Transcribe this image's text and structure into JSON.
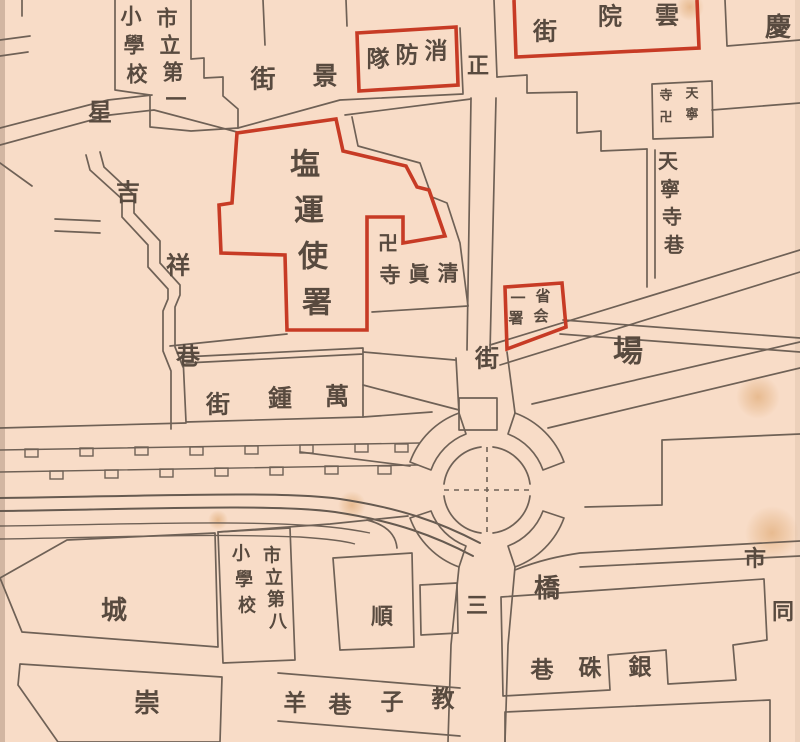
{
  "map": {
    "type": "historical-city-map",
    "colors": {
      "paper": "#f8dcc7",
      "line": "#6f6156",
      "red": "#c73b25",
      "ink": "#584a3f"
    },
    "landmarks_in_red": [
      "消防隊",
      "雲院街",
      "塩運使署",
      "省会一署"
    ],
    "labels": [
      {
        "name": "school-1-col-right",
        "text": "市立第一",
        "x": 167,
        "y": 18,
        "dx": 3,
        "dy": 27,
        "size": 21
      },
      {
        "name": "school-1-col-left",
        "text": "小學校",
        "x": 131,
        "y": 16,
        "dx": 3,
        "dy": 29,
        "size": 21
      },
      {
        "name": "star",
        "text": "星",
        "x": 100,
        "y": 112,
        "size": 24
      },
      {
        "name": "jing-street",
        "chars": [
          {
            "c": "景",
            "x": 325,
            "y": 76
          },
          {
            "c": "街",
            "x": 263,
            "y": 79
          }
        ],
        "size": 25
      },
      {
        "name": "fire-brigade-box-label",
        "text": "消防隊",
        "x": 436,
        "y": 51,
        "dx": -29,
        "dy": 4,
        "size": 23
      },
      {
        "name": "zheng",
        "text": "正",
        "x": 478,
        "y": 66,
        "size": 22
      },
      {
        "name": "yunyuan-street-box-label",
        "chars": [
          {
            "c": "雲",
            "x": 667,
            "y": 15
          },
          {
            "c": "院",
            "x": 610,
            "y": 16
          },
          {
            "c": "街",
            "x": 545,
            "y": 31
          }
        ],
        "size": 24
      },
      {
        "name": "qing-char",
        "text": "慶",
        "x": 778,
        "y": 28,
        "size": 26
      },
      {
        "name": "tianning-temple-box-col-right",
        "text": "天寧",
        "x": 692,
        "y": 94,
        "dx": 0,
        "dy": 21,
        "size": 13
      },
      {
        "name": "tianning-temple-box-col-left",
        "text": "寺卍",
        "x": 666,
        "y": 96,
        "dx": 0,
        "dy": 22,
        "size": 13
      },
      {
        "name": "tianning-temple-lane",
        "text": "天寧寺巷",
        "x": 668,
        "y": 161,
        "dx": 2,
        "dy": 28,
        "size": 20
      },
      {
        "name": "salt-transport-office",
        "text": "塩運使署",
        "x": 305,
        "y": 165,
        "dx": 4,
        "dy": 46,
        "size": 30
      },
      {
        "name": "mosque-swastika",
        "text": "卍",
        "x": 388,
        "y": 243,
        "size": 20
      },
      {
        "name": "mosque",
        "text": "清眞寺",
        "x": 448,
        "y": 273,
        "dx": -29,
        "dy": 1,
        "size": 21
      },
      {
        "name": "shenghui-box-col-right",
        "text": "省会",
        "x": 543,
        "y": 296,
        "dx": -2,
        "dy": 20,
        "size": 15
      },
      {
        "name": "shenghui-box-col-left",
        "text": "一署",
        "x": 518,
        "y": 298,
        "dx": -2,
        "dy": 20,
        "size": 15
      },
      {
        "name": "jie-junction",
        "text": "街",
        "x": 487,
        "y": 358,
        "size": 24
      },
      {
        "name": "chang",
        "text": "場",
        "x": 628,
        "y": 352,
        "size": 30
      },
      {
        "name": "jixiang-lane",
        "chars": [
          {
            "c": "吉",
            "x": 128,
            "y": 192
          },
          {
            "c": "祥",
            "x": 178,
            "y": 265
          },
          {
            "c": "巷",
            "x": 188,
            "y": 356
          }
        ],
        "size": 24
      },
      {
        "name": "wanzhong-street",
        "chars": [
          {
            "c": "萬",
            "x": 337,
            "y": 396
          },
          {
            "c": "鍾",
            "x": 280,
            "y": 398
          },
          {
            "c": "街",
            "x": 218,
            "y": 404
          }
        ],
        "size": 24
      },
      {
        "name": "qiao",
        "text": "橋",
        "x": 547,
        "y": 589,
        "size": 26
      },
      {
        "name": "san",
        "text": "三",
        "x": 477,
        "y": 606,
        "size": 22
      },
      {
        "name": "yinzhu-lane",
        "chars": [
          {
            "c": "銀",
            "x": 640,
            "y": 667
          },
          {
            "c": "硃",
            "x": 590,
            "y": 668
          },
          {
            "c": "巷",
            "x": 542,
            "y": 670
          }
        ],
        "size": 23
      },
      {
        "name": "shi-right-edge",
        "text": "市",
        "x": 755,
        "y": 559,
        "size": 22
      },
      {
        "name": "tong-right-edge",
        "text": "同",
        "x": 783,
        "y": 612,
        "size": 22
      },
      {
        "name": "shun",
        "text": "順",
        "x": 382,
        "y": 617,
        "size": 22
      },
      {
        "name": "school-8-col-right",
        "text": "市立第八",
        "x": 272,
        "y": 556,
        "dx": 2,
        "dy": 22,
        "size": 18
      },
      {
        "name": "school-8-col-left",
        "text": "小學校",
        "x": 241,
        "y": 554,
        "dx": 3,
        "dy": 26,
        "size": 18
      },
      {
        "name": "cheng",
        "text": "城",
        "x": 114,
        "y": 611,
        "size": 26
      },
      {
        "name": "chong",
        "text": "崇",
        "x": 147,
        "y": 704,
        "size": 26
      },
      {
        "name": "jiaozi-lane",
        "chars": [
          {
            "c": "教",
            "x": 443,
            "y": 699
          },
          {
            "c": "子",
            "x": 392,
            "y": 702
          },
          {
            "c": "巷",
            "x": 340,
            "y": 705
          }
        ],
        "size": 23
      },
      {
        "name": "yang",
        "text": "羊",
        "x": 295,
        "y": 703,
        "size": 23
      }
    ]
  }
}
